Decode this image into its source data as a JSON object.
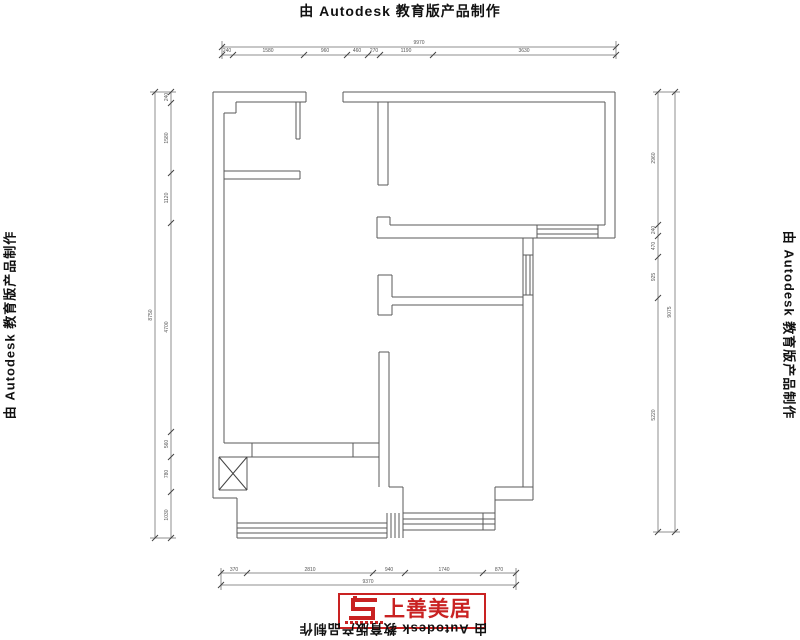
{
  "watermark": {
    "text": "由 Autodesk 教育版产品制作"
  },
  "logo": {
    "name": "上善美居",
    "accent_color": "#c92222"
  },
  "plan": {
    "wall_color": "#5a5a5a",
    "dim_color": "#8f8f8f"
  },
  "dimensions": {
    "top": {
      "overall": "9970",
      "segments": [
        "240",
        "1580",
        "960",
        "460",
        "270",
        "1190",
        "3630"
      ]
    },
    "left": {
      "overall": "8750",
      "segments": [
        "240",
        "1580",
        "1120",
        "4700",
        "560",
        "780",
        "1030"
      ]
    },
    "right": {
      "overall": "9075",
      "segments": [
        "2960",
        "240",
        "470",
        "925",
        "5220"
      ]
    },
    "bottom": {
      "overall": "9370",
      "segments": [
        "370",
        "2810",
        "940",
        "1740",
        "870"
      ]
    }
  },
  "dim_labels": [
    {
      "side": "top-overall",
      "t": "9970",
      "x": 419,
      "y": 44,
      "r": 0
    },
    {
      "side": "top",
      "t": "240",
      "x": 227,
      "y": 52,
      "r": 0
    },
    {
      "side": "top",
      "t": "1580",
      "x": 268,
      "y": 52,
      "r": 0
    },
    {
      "side": "top",
      "t": "960",
      "x": 325,
      "y": 52,
      "r": 0
    },
    {
      "side": "top",
      "t": "460",
      "x": 357,
      "y": 52,
      "r": 0
    },
    {
      "side": "top",
      "t": "270",
      "x": 374,
      "y": 52,
      "r": 0
    },
    {
      "side": "top",
      "t": "1190",
      "x": 406,
      "y": 52,
      "r": 0
    },
    {
      "side": "top",
      "t": "3630",
      "x": 524,
      "y": 52,
      "r": 0
    },
    {
      "side": "left-overall",
      "t": "8750",
      "x": 152,
      "y": 315,
      "r": -90
    },
    {
      "side": "left",
      "t": "240",
      "x": 168,
      "y": 97,
      "r": -90
    },
    {
      "side": "left",
      "t": "1580",
      "x": 168,
      "y": 138,
      "r": -90
    },
    {
      "side": "left",
      "t": "1120",
      "x": 168,
      "y": 198,
      "r": -90
    },
    {
      "side": "left",
      "t": "4700",
      "x": 168,
      "y": 327,
      "r": -90
    },
    {
      "side": "left",
      "t": "560",
      "x": 168,
      "y": 444,
      "r": -90
    },
    {
      "side": "left",
      "t": "780",
      "x": 168,
      "y": 474,
      "r": -90
    },
    {
      "side": "left",
      "t": "1030",
      "x": 168,
      "y": 515,
      "r": -90
    },
    {
      "side": "right",
      "t": "2960",
      "x": 655,
      "y": 158,
      "r": -90
    },
    {
      "side": "right",
      "t": "240",
      "x": 655,
      "y": 230,
      "r": -90
    },
    {
      "side": "right",
      "t": "470",
      "x": 655,
      "y": 246,
      "r": -90
    },
    {
      "side": "right",
      "t": "925",
      "x": 655,
      "y": 277,
      "r": -90
    },
    {
      "side": "right",
      "t": "5220",
      "x": 655,
      "y": 415,
      "r": -90
    },
    {
      "side": "right-overall",
      "t": "9075",
      "x": 671,
      "y": 312,
      "r": -90
    },
    {
      "side": "bottom",
      "t": "370",
      "x": 234,
      "y": 571,
      "r": 0
    },
    {
      "side": "bottom",
      "t": "2810",
      "x": 310,
      "y": 571,
      "r": 0
    },
    {
      "side": "bottom",
      "t": "940",
      "x": 389,
      "y": 571,
      "r": 0
    },
    {
      "side": "bottom",
      "t": "1740",
      "x": 444,
      "y": 571,
      "r": 0
    },
    {
      "side": "bottom",
      "t": "870",
      "x": 499,
      "y": 571,
      "r": 0
    },
    {
      "side": "bottom-overall",
      "t": "9370",
      "x": 368,
      "y": 583,
      "r": 0
    }
  ]
}
